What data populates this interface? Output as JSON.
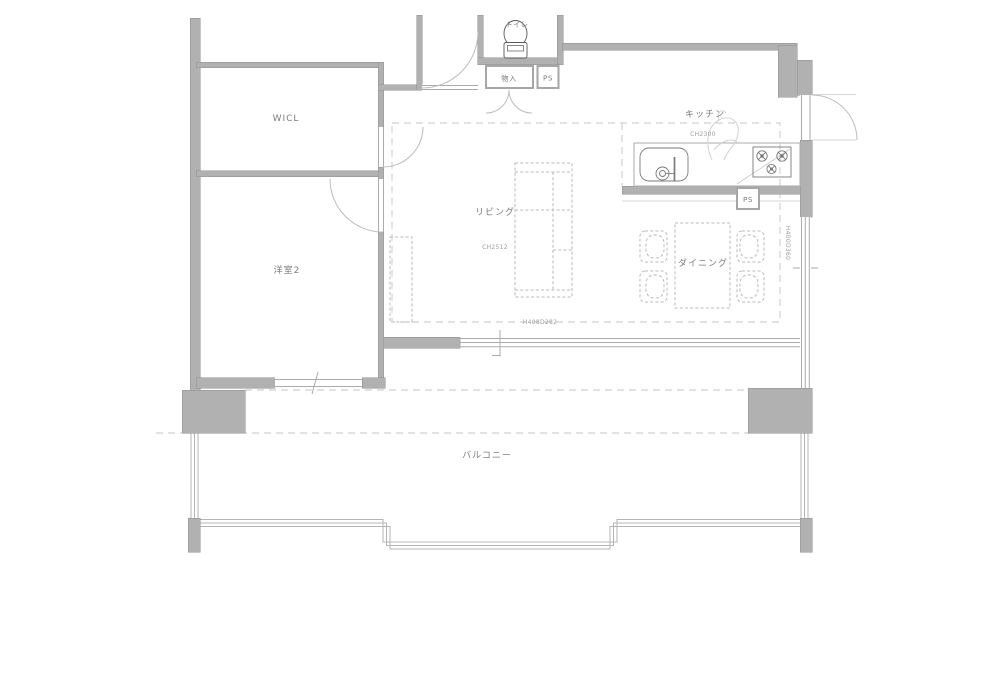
{
  "plan": {
    "rooms": {
      "wicl": {
        "label": "WICL"
      },
      "bedroom2": {
        "label": "洋室2"
      },
      "living": {
        "label": "リビング",
        "ceiling_height": "CH2512"
      },
      "kitchen": {
        "label": "キッチン",
        "ceiling_height": "CH2300"
      },
      "dining": {
        "label": "ダイニング"
      },
      "balcony": {
        "label": "バルコニー"
      },
      "toilet": {
        "label": "トイレ"
      },
      "storage": {
        "label": "物入"
      }
    },
    "pipe_shafts": {
      "hall_ps": "PS",
      "kitchen_ps": "PS"
    },
    "window_annotations": {
      "living_balcony_window": "H408D282",
      "dining_side_window": "H400D360"
    },
    "colors": {
      "wall": "#b1b1b1",
      "wall_edge": "#8f8f8f",
      "thin_line": "#ababab",
      "dashed_line": "#c4c4c4",
      "room_text": "#7d7d7d",
      "annotation_text": "#9b9b9b",
      "fixture_line": "#5a5a5a",
      "background": "#ffffff"
    }
  }
}
